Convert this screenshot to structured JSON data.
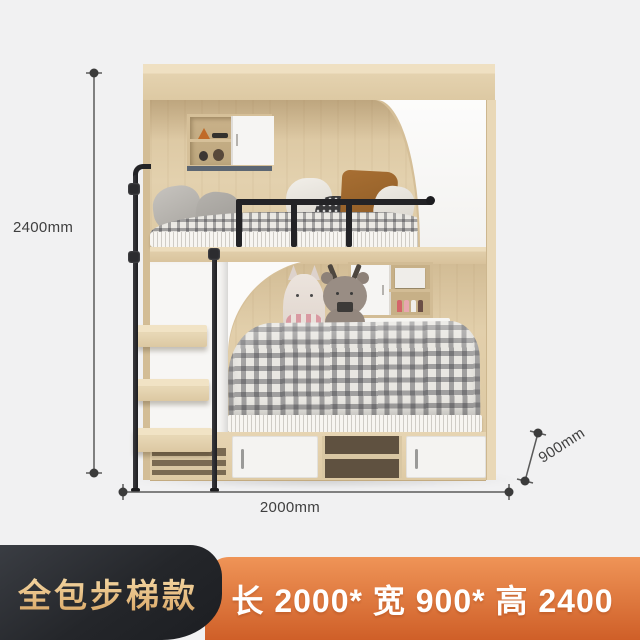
{
  "product_annotations": {
    "height_label": "2400mm",
    "length_label": "2000mm",
    "depth_label": "900mm"
  },
  "banner": {
    "style_tag": "全包步梯款",
    "size_text": "长 2000* 宽 900* 高 2400"
  },
  "colors": {
    "background": "#f1f1f2",
    "wood": "#e2cfab",
    "panel_white": "#fafafa",
    "metal_black": "#232326",
    "dimension_line": "#555555",
    "dimension_text": "#3f3f3f",
    "banner_dark_bg": "#26282c",
    "banner_gold_text": "#e9c186",
    "banner_orange_top": "#ef9457",
    "banner_orange_bottom": "#cf5f28",
    "banner_size_text": "#ffffff"
  }
}
